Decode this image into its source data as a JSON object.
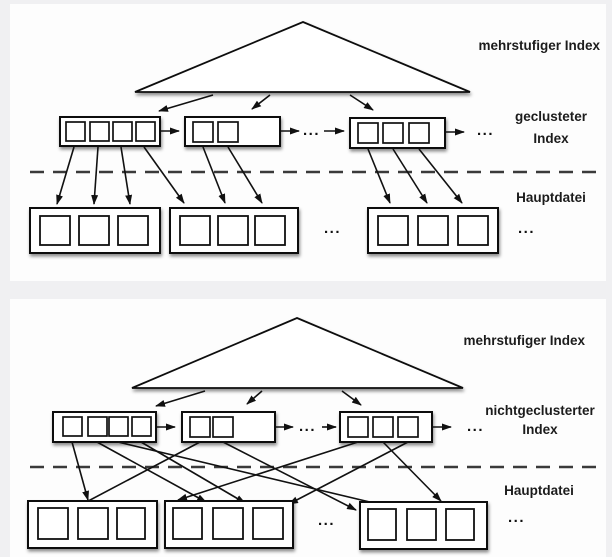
{
  "page": {
    "background_color": "#f0f0f2",
    "panel_color": "#fdfdfd",
    "line_color": "#111111",
    "text_color": "#1c1c1c"
  },
  "diagram_top": {
    "name": "clustered-index-diagram",
    "label_pyramid": "mehrstufiger Index",
    "label_index_line1": "geclusteter",
    "label_index_line2": "Index",
    "label_mainfile": "Hauptdatei",
    "ellipsis": "..."
  },
  "diagram_bottom": {
    "name": "nonclustered-index-diagram",
    "label_pyramid": "mehrstufiger Index",
    "label_index_line1": "nichtgeclusterter",
    "label_index_line2": "Index",
    "label_mainfile": "Hauptdatei",
    "ellipsis": "..."
  }
}
